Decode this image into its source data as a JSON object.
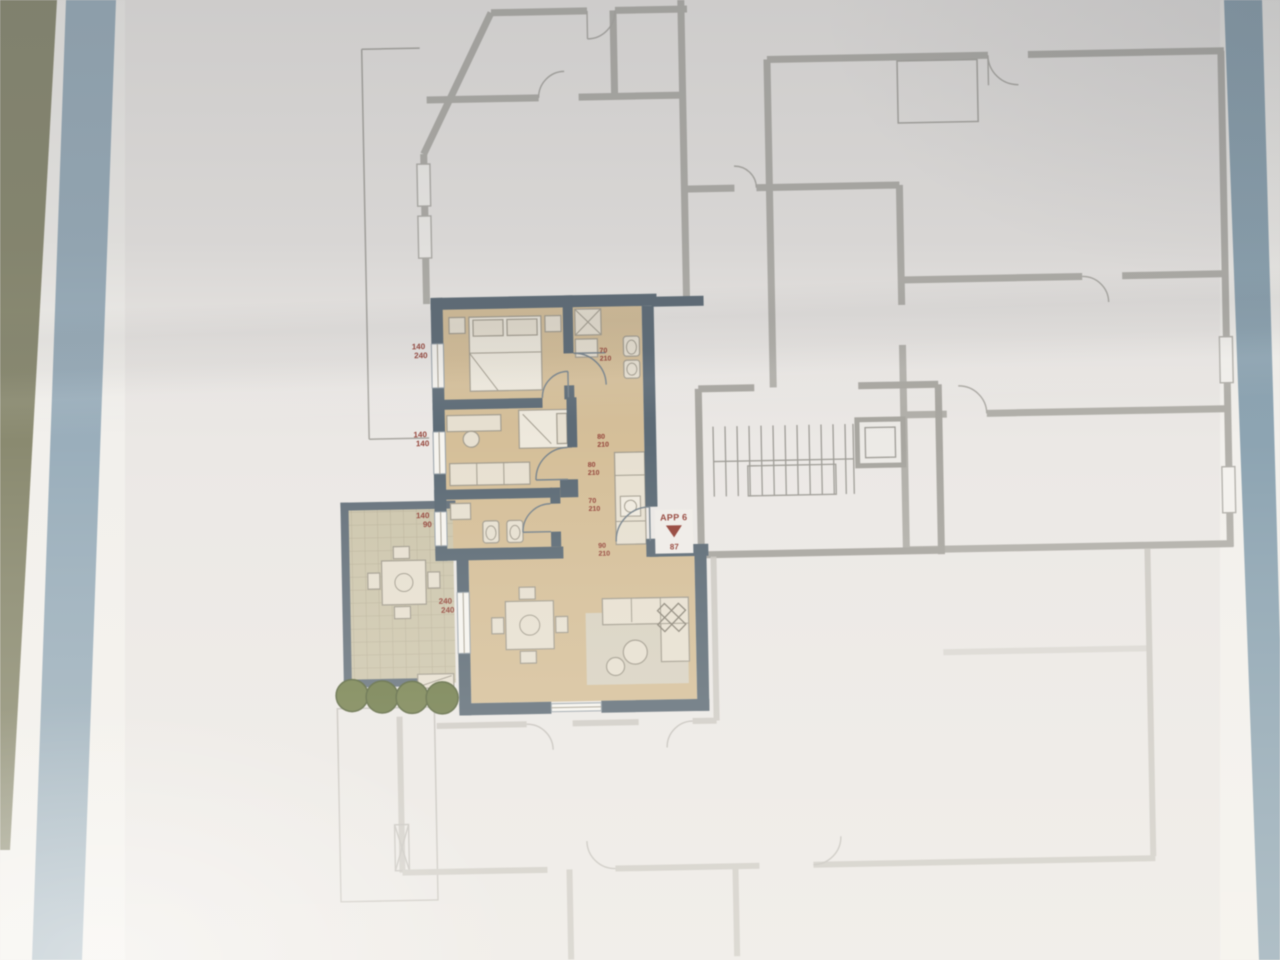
{
  "plan": {
    "apartment_label": "APP 6",
    "apartment_area": "87",
    "window_labels": [
      {
        "top": "140",
        "bottom": "240"
      },
      {
        "top": "140",
        "bottom": "140"
      },
      {
        "top": "140",
        "bottom": "90"
      },
      {
        "top": "240",
        "bottom": "240"
      }
    ],
    "door_labels": [
      {
        "top": "80",
        "bottom": "210"
      },
      {
        "top": "70",
        "bottom": "210"
      },
      {
        "top": "80",
        "bottom": "210"
      },
      {
        "top": "70",
        "bottom": "210"
      },
      {
        "top": "90",
        "bottom": "210"
      }
    ],
    "icons": {
      "entry_arrow": "down-triangle"
    },
    "colors": {
      "frame_blue_left": "#9aaebb",
      "frame_blue_right": "#8da4b2",
      "wall_olive": "#8a8a70",
      "paper": "#ebe8e5",
      "apartment_wall": "#5d6b76",
      "apartment_floor": "#d5bf99",
      "terrace_floor": "#cdc6ad",
      "bush_green": "#76814f",
      "gray_wall": "#b2b0aa",
      "faint_wall": "#c9c6c0",
      "label_red": "#94443a"
    }
  }
}
